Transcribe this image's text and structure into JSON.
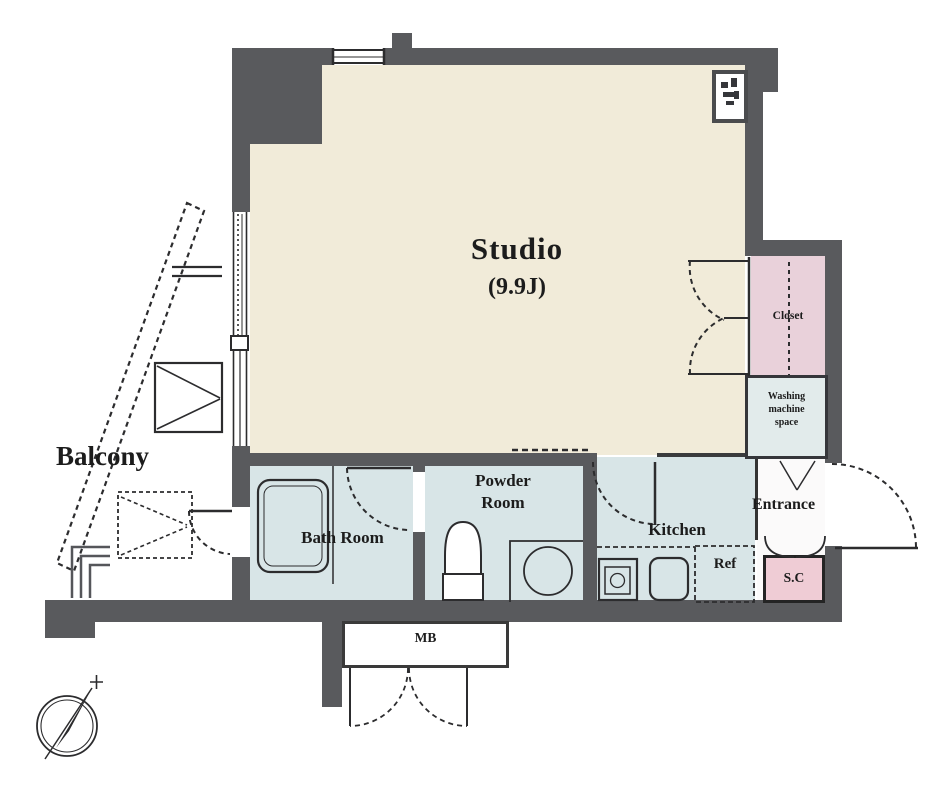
{
  "colors": {
    "wall": "#595a5d",
    "line": "#2c2c2e",
    "studio_floor": "#f1ebd9",
    "wet_floor": "#d8e5e7",
    "closet_fill": "#e9d1da",
    "sc_fill": "#efccd5",
    "washing_fill": "#e2ebeb",
    "background": "#ffffff"
  },
  "labels": {
    "studio": {
      "name": "Studio",
      "size": "(9.9J)"
    },
    "balcony": "Balcony",
    "bath": "Bath Room",
    "powder": {
      "line1": "Powder",
      "line2": "Room"
    },
    "kitchen": "Kitchen",
    "entrance": "Entrance",
    "closet": "Closet",
    "washing": {
      "line1": "Washing",
      "line2": "machine",
      "line3": "space"
    },
    "shoe_closet": "S.C",
    "refrigerator": "Ref",
    "meter_box": "MB"
  }
}
